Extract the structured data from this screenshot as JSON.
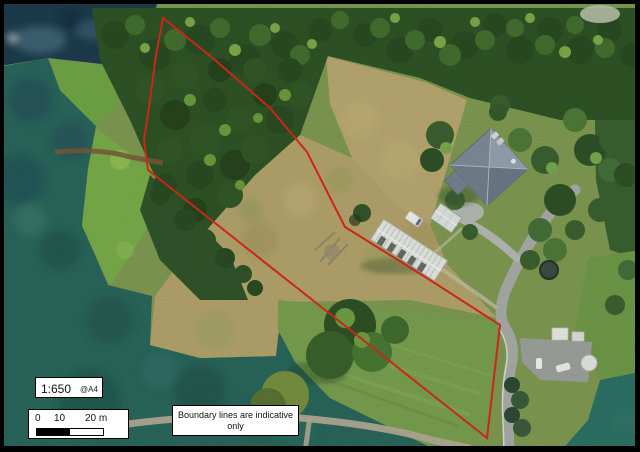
{
  "map": {
    "description": "Aerial photo with property boundary overlay",
    "boundary_color": "#d8291a",
    "boundary_points": "163,18 215,60 270,108 307,152 345,227 430,280 500,325 487,438 148,170 144,140 150,100 156,55",
    "palette": {
      "deep_water": "#1d3d4d",
      "shallow_water": "#2a675c",
      "bush": "#2a4c22",
      "dry_grass": "#b9a871",
      "green_paddock": "#79a04f",
      "road": "#a8ada8",
      "house_roof": "#7e8b98"
    }
  },
  "scale_box": {
    "scale": "1:650",
    "paper_size": "@A4"
  },
  "scale_bar": {
    "tick_labels": [
      "0",
      "10",
      "20 m"
    ]
  },
  "note_box": {
    "text": "Boundary lines are indicative only"
  }
}
